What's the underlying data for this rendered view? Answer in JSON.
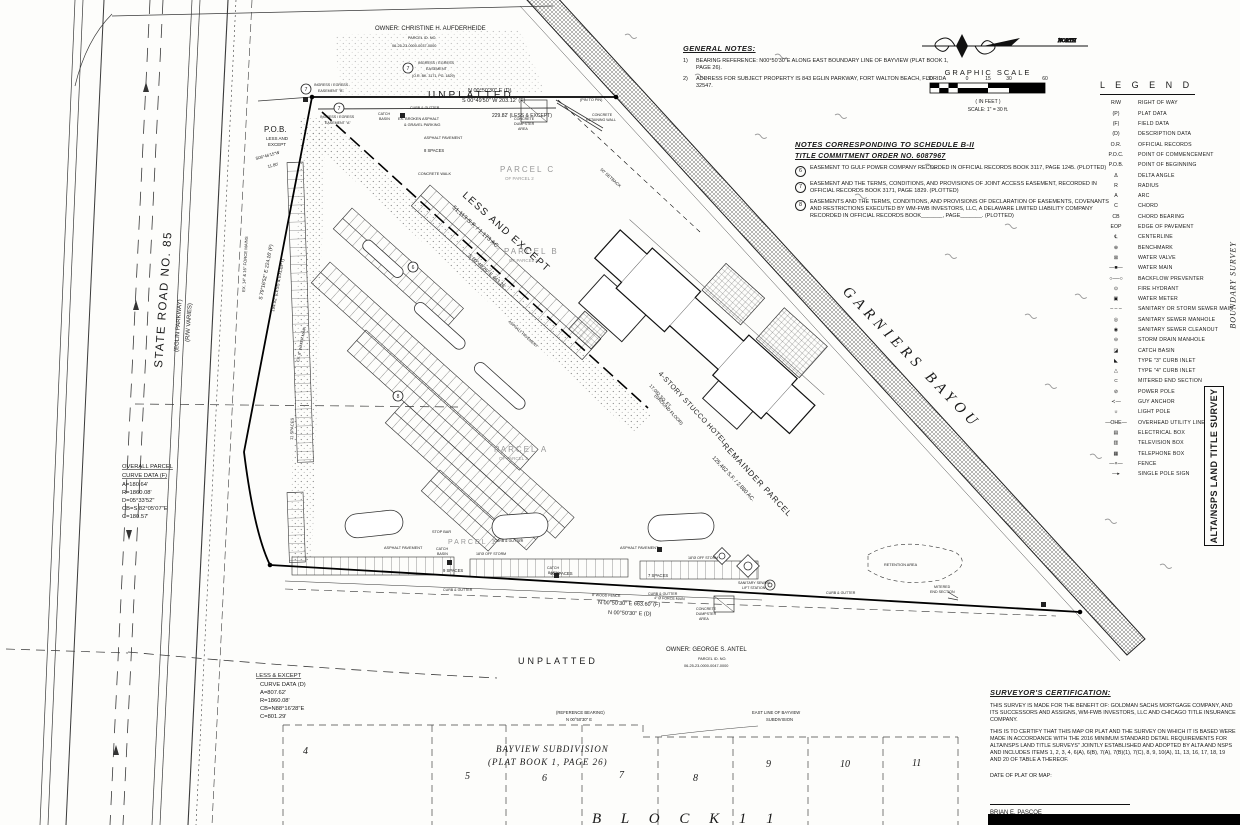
{
  "north": {
    "label": "NORTH"
  },
  "scale": {
    "title": "GRAPHIC SCALE",
    "ticks": [
      "30",
      "0",
      "15",
      "30",
      "60"
    ],
    "units": "( IN FEET )",
    "note": "SCALE: 1\" = 30 ft."
  },
  "general_notes": {
    "title": "GENERAL NOTES:",
    "items": [
      {
        "num": "1)",
        "text": "BEARING REFERENCE: N00°50'30\"E ALONG EAST BOUNDARY LINE OF BAYVIEW (PLAT BOOK 1, PAGE 26)."
      },
      {
        "num": "2)",
        "text": "ADDRESS FOR SUBJECT PROPERTY IS 843 EGLIN PARKWAY, FORT WALTON BEACH, FLORIDA 32547."
      }
    ]
  },
  "schedule_notes": {
    "title_line1": "NOTES CORRESPONDING TO SCHEDULE B-II",
    "title_line2": "TITLE COMMITMENT ORDER NO. 6087967",
    "items": [
      {
        "num": "6",
        "text": "EASEMENT TO GULF POWER COMPANY RECORDED IN OFFICIAL RECORDS BOOK 3117, PAGE 1245. (PLOTTED)"
      },
      {
        "num": "7",
        "text": "EASEMENT AND THE TERMS, CONDITIONS, AND PROVISIONS OF JOINT ACCESS EASEMENT, RECORDED IN OFFICIAL RECORDS BOOK 3171, PAGE 1829. (PLOTTED)"
      },
      {
        "num": "8",
        "text": "EASEMENTS AND THE TERMS, CONDITIONS, AND PROVISIONS OF DECLARATION OF EASEMENTS, COVENANTS AND RESTRICTIONS EXECUTED BY WM-FWB INVESTORS, LLC, A DELAWARE LIMITED LIABILITY COMPANY RECORDED IN OFFICIAL RECORDS BOOK_______, PAGE_______. (PLOTTED)"
      }
    ]
  },
  "legend": {
    "title": "L E G E N D",
    "items": [
      {
        "sym": "R/W",
        "label": "RIGHT OF WAY"
      },
      {
        "sym": "(P)",
        "label": "PLAT DATA"
      },
      {
        "sym": "(F)",
        "label": "FIELD DATA"
      },
      {
        "sym": "(D)",
        "label": "DESCRIPTION DATA"
      },
      {
        "sym": "O.R.",
        "label": "OFFICIAL RECORDS"
      },
      {
        "sym": "P.O.C.",
        "label": "POINT OF COMMENCEMENT"
      },
      {
        "sym": "P.O.B.",
        "label": "POINT OF BEGINNING"
      },
      {
        "sym": "Δ",
        "label": "DELTA ANGLE"
      },
      {
        "sym": "R",
        "label": "RADIUS"
      },
      {
        "sym": "A",
        "label": "ARC"
      },
      {
        "sym": "C",
        "label": "CHORD"
      },
      {
        "sym": "CB",
        "label": "CHORD BEARING"
      },
      {
        "sym": "EOP",
        "label": "EDGE OF PAVEMENT"
      },
      {
        "sym": "℄",
        "label": "CENTERLINE"
      },
      {
        "sym": "⊕",
        "label": "BENCHMARK"
      },
      {
        "sym": "⊠",
        "label": "WATER VALVE"
      },
      {
        "sym": "—■—",
        "label": "WATER MAIN"
      },
      {
        "sym": "○──○",
        "label": "BACKFLOW PREVENTER"
      },
      {
        "sym": "⊙",
        "label": "FIRE HYDRANT"
      },
      {
        "sym": "▣",
        "label": "WATER METER"
      },
      {
        "sym": "– – –",
        "label": "SANITARY OR STORM SEWER MAIN"
      },
      {
        "sym": "◎",
        "label": "SANITARY SEWER MANHOLE"
      },
      {
        "sym": "◉",
        "label": "SANITARY SEWER CLEANOUT"
      },
      {
        "sym": "⊖",
        "label": "STORM DRAIN MANHOLE"
      },
      {
        "sym": "◪",
        "label": "CATCH BASIN"
      },
      {
        "sym": "◣",
        "label": "TYPE \"3\" CURB INLET"
      },
      {
        "sym": "△",
        "label": "TYPE \"4\" CURB INLET"
      },
      {
        "sym": "⊂",
        "label": "MITERED END SECTION"
      },
      {
        "sym": "⊘",
        "label": "POWER POLE"
      },
      {
        "sym": "≺—",
        "label": "GUY ANCHOR"
      },
      {
        "sym": "☼",
        "label": "LIGHT POLE"
      },
      {
        "sym": "—OHE—",
        "label": "OVERHEAD UTILITY LINE"
      },
      {
        "sym": "▤",
        "label": "ELECTRICAL BOX"
      },
      {
        "sym": "▥",
        "label": "TELEVISION BOX"
      },
      {
        "sym": "▦",
        "label": "TELEPHONE BOX"
      },
      {
        "sym": "—×—",
        "label": "FENCE"
      },
      {
        "sym": "—▸",
        "label": "SINGLE POLE SIGN"
      }
    ]
  },
  "certification": {
    "title": "SURVEYOR'S CERTIFICATION:",
    "para1": "THIS SURVEY IS MADE FOR THE BENEFIT OF: GOLDMAN SACHS MORTGAGE COMPANY, AND ITS SUCCESSORS AND ASSIGNS, WM-FWB INVESTORS, LLC AND CHICAGO TITLE INSURANCE COMPANY.",
    "para2": "THIS IS TO CERTIFY THAT THIS MAP OR PLAT AND THE SURVEY ON WHICH IT IS BASED WERE MADE IN ACCORDANCE WITH THE 2016 MINIMUM STANDARD DETAIL REQUIREMENTS FOR ALTA/NSPS LAND TITLE SURVEYS\" JOINTLY ESTABLISHED AND ADOPTED BY ALTA AND NSPS AND INCLUDES ITEMS 1, 2, 3, 4, 6(A), 6(B), 7(A), 7(B)(1), 7(C), 8, 9, 10(A), 11, 13, 16, 17, 18, 19 AND 20 OF TABLE A THEREOF.",
    "date_label": "DATE OF PLAT OR MAP:",
    "surveyor": "BRIAN E. PASCOE",
    "surveyor_title": "PROFESSIONAL SURVEYOR AND MAPPER, NO. 5930"
  },
  "side_titles": {
    "main": "ALTA/NSPS LAND TITLE SURVEY",
    "sub": "BOUNDARY SURVEY"
  },
  "lots": [
    "4",
    "5",
    "6",
    "7",
    "8",
    "9",
    "10",
    "11"
  ],
  "labels": {
    "owner_top_1": "OWNER:  CHRISTINE  H.  AUFDERHEIDE",
    "owner_top_2": "PARCEL  ID.  NO.",
    "owner_top_3": "06-25-23-0000-0037-0000",
    "unplatted_top": "UNPLATTED",
    "broken_asphalt_1": "EX. BROKEN ASPHALT",
    "broken_asphalt_2": "& GRAVEL PARKING",
    "num6": "6",
    "num7": "7",
    "num8": "8",
    "ease7_or_1": "INGRESS / EGRESS",
    "ease7_or_2": "EASEMENT",
    "ease7_or_3": "(O.R. BK. 3171, PG. 1829)",
    "ease_b_1": "INGRESS / EGRESS",
    "ease_b_2": "EASEMENT \"B\"",
    "ease_a_1": "INGRESS / EGRESS",
    "ease_a_2": "EASEMENT \"A\"",
    "dim_top_1": "N 00°50'30\" E (D)",
    "dim_top_2": "S 00°49'50\" W     203.12' (F)",
    "pin_to_pin": "(PIN TO PIN)",
    "dim_top_3": "229.82' (LESS & EXCEPT)",
    "pob_1": "P.O.B.",
    "pob_2": "LESS AND",
    "pob_3": "EXCEPT",
    "pob_4": "S06°46'15\"W",
    "pob_5": "11.80'",
    "dim_west_1": "S 79°16'52\" E    224.16' (F)",
    "dim_west_2": "194.92' (LESS & EXCEPT)",
    "force_mains": "EX. 14\" & 16\" FORCE MAINS",
    "water_main8": "EX. 8\" WATER MAIN",
    "state_road_1": "STATE ROAD NO. 85",
    "state_road_2": "(EGLIN PARKWAY)",
    "state_road_3": "(R/W VARIES)",
    "spaces_11": "11 SPACES",
    "spaces_8": "8 SPACES",
    "spaces_9": "9 SPACES",
    "spaces_10": "10 SPACES",
    "spaces_7": "7 SPACES",
    "asphalt": "ASPHALT PAVEMENT",
    "conc_walk": "CONCRETE WALK",
    "curb_gutter": "CURB & GUTTER",
    "catch_1": "CATCH",
    "catch_2": "BASIN",
    "stop_bar": "STOP BAR",
    "storm18": "18\"Ø OFF STORM",
    "wood_fence": "8' WOOD FENCE",
    "force_main4": "4\" Ø FORCE MAIN",
    "lift_1": "SANITARY SEWER",
    "lift_2": "LIFT STATION",
    "retention": "RETENTION AREA",
    "mitered_1": "MITERED",
    "mitered_2": "END SECTION",
    "dumpster_1": "CONCRETE",
    "dumpster_2": "DUMPSTER",
    "dumpster_3": "AREA",
    "retaining_1": "CONCRETE",
    "retaining_2": "RETAINING WALL",
    "parcel_c_1": "PARCEL  C",
    "parcel_c_2": "OF PARCEL 2",
    "parcel_b_1": "PARCEL  B",
    "parcel_b_2": "OF PARCEL 2",
    "parcel_a_1": "PARCEL  A",
    "parcel_a_2": "OF PARCEL 2",
    "parcel_1": "PARCEL  1",
    "less_1": "LESS  AND  EXCEPT",
    "less_2": "51,113 S.F. / 1.173 AC.",
    "setback50": "50' SETBACK",
    "dim_diag": "S 60°40'26\" E   443.26'",
    "hotel_1": "4-STORY STUCCO HOTEL",
    "hotel_2": "17,092 SQ. FT.",
    "hotel_3": "(GROUND FLOOR)",
    "remainder_1": "REMAINDER  PARCEL",
    "remainder_2": "125,462 S.F. / 2.880 AC.",
    "garniers": "GARNIERS  BAYOU",
    "oc_title1": "OVERALL PARCEL",
    "oc_title2": "CURVE DATA (F)",
    "oc_a": "A=180.64'",
    "oc_r": "R=1860.08'",
    "oc_d": "D=05°33'52\"",
    "oc_cb": "CB=S 82°05'07\"E",
    "oc_c": "C=180.57'",
    "lc_title1": "LESS & EXCEPT",
    "lc_title2": "CURVE DATA (D)",
    "lc_a": "A=807.62'",
    "lc_r": "R=1860.08'",
    "lc_cb": "CB=N88°16'28\"E",
    "lc_c": "C=801.29'",
    "dim_bot_1": "N 00°50'30\" E      663.60' (F)",
    "dim_bot_2": "N 00°50'30\" E (D)",
    "unplatted_bottom": "UNPLATTED",
    "owner_bot_1": "OWNER:  GEORGE  S.  ANTEL",
    "owner_bot_2": "PARCEL  ID.  NO.",
    "owner_bot_3": "06-25-23-0000-0047-0000",
    "ref_1": "(REFERENCE BEARING)",
    "ref_2": "N 00°50'30\" E",
    "eastline_1": "EAST LINE OF BAYVIEW",
    "eastline_2": "SUBDIVISION",
    "bayview_1": "BAYVIEW  SUBDIVISION",
    "bayview_2": "(PLAT BOOK 1, PAGE 26)",
    "block11": "B  L  O  C  K       1  1"
  }
}
